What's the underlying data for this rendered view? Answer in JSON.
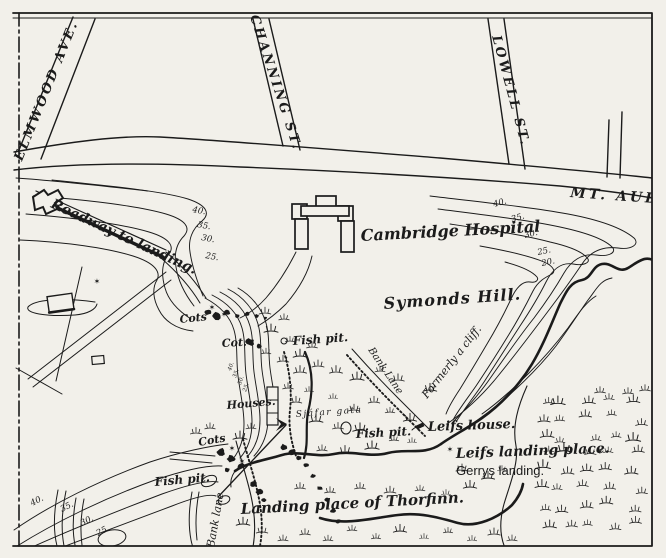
{
  "map": {
    "streets": {
      "elmwood": "ELMWOOD AVE.",
      "channing": "CHANNING ST.",
      "lowell": "LOWELL ST.",
      "mt_auburn": "MT. AUBURN"
    },
    "places": {
      "roadway": "Roadway to landing.",
      "hospital": "Cambridge Hospital",
      "symonds_hill": "Symonds Hill.",
      "formerly_cliff": "Formerly a cliff.",
      "bank_lane_upper": "Bank Lane",
      "bank_lane_lower": "Bank lane",
      "leifs_house": "Leifs house.",
      "leifs_landing": "Leifs landing place.",
      "gerrys_landing": "Gerrys landing.",
      "thorfinn_landing": "Landing place of Thorfinn.",
      "houses": "Houses.",
      "cots_upper": "Cots",
      "cot_mid": "Cot.",
      "cots_lower": "Cots",
      "fish_pit_upper": "Fish pit.",
      "fish_pit_mid": "Fish pit.",
      "fish_pit_lower": "Fish pit.",
      "gata": "Sjáfar gata"
    },
    "contour_labels": {
      "left": [
        "40.",
        "35.",
        "30.",
        "25."
      ],
      "right": [
        "40.",
        "35.",
        "30.",
        "25.",
        "20."
      ],
      "bottom_left": [
        "40.",
        "35.",
        "30.",
        "25."
      ],
      "bank": [
        "40.",
        "35.",
        "30.",
        "25."
      ]
    },
    "icons": {
      "star": "✶",
      "marsh": "marsh-tuft"
    },
    "colors": {
      "ink": "#1b1b1b",
      "paper": "#f2f0ea"
    }
  }
}
